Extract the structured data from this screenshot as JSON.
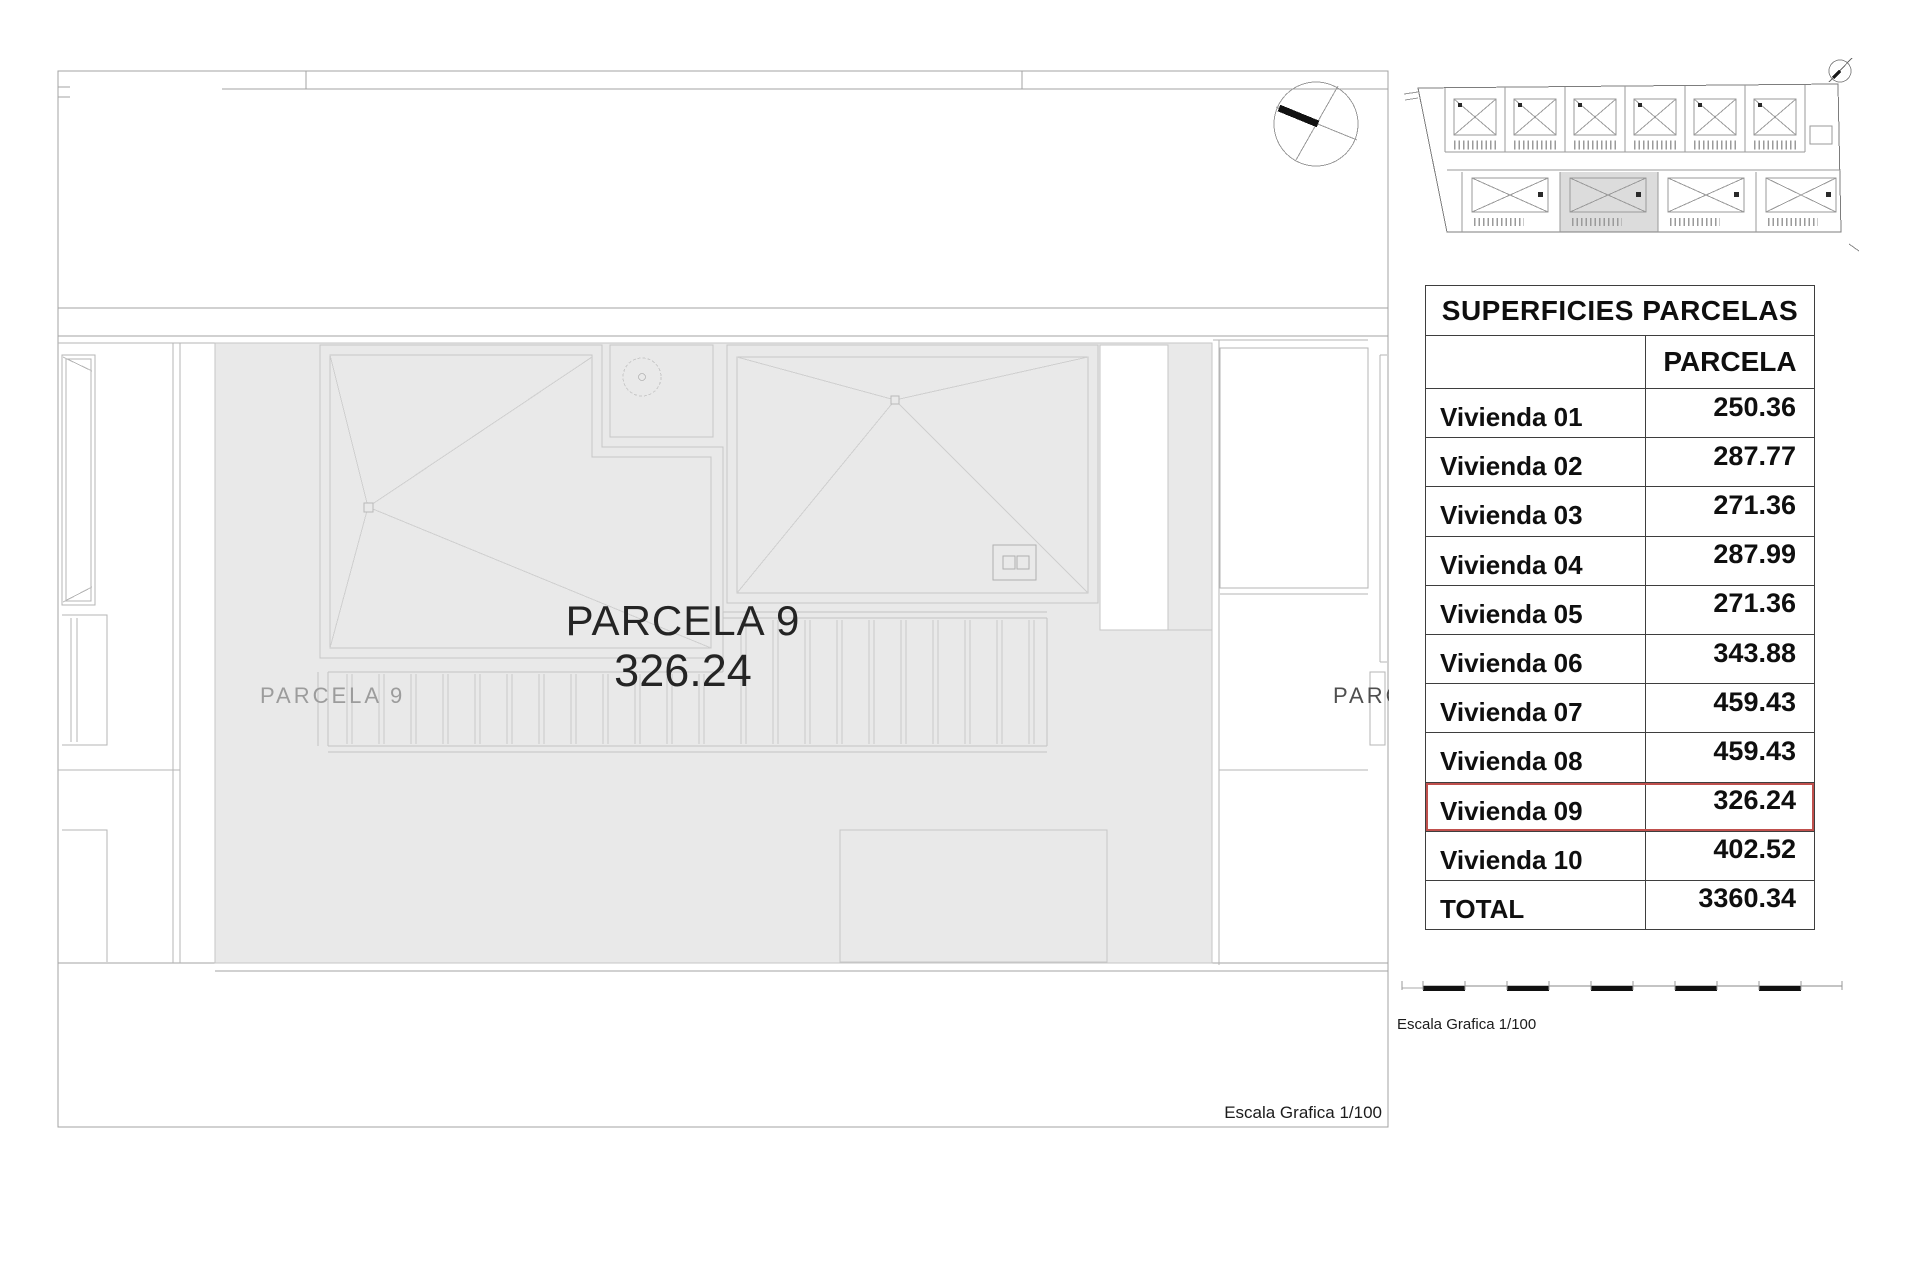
{
  "plan": {
    "parcel_title": "PARCELA 9",
    "parcel_area": "326.24",
    "left_parcel_label": "PARCELA 9",
    "right_parcel_label_clipped": "PARC",
    "scale_caption": "Escala Grafica 1/100"
  },
  "sidebar": {
    "table": {
      "title": "SUPERFICIES PARCELAS",
      "value_column_header": "PARCELA",
      "rows": [
        {
          "label": "Vivienda 01",
          "value": "250.36",
          "highlighted": false
        },
        {
          "label": "Vivienda 02",
          "value": "287.77",
          "highlighted": false
        },
        {
          "label": "Vivienda 03",
          "value": "271.36",
          "highlighted": false
        },
        {
          "label": "Vivienda 04",
          "value": "287.99",
          "highlighted": false
        },
        {
          "label": "Vivienda 05",
          "value": "271.36",
          "highlighted": false
        },
        {
          "label": "Vivienda 06",
          "value": "343.88",
          "highlighted": false
        },
        {
          "label": "Vivienda 07",
          "value": "459.43",
          "highlighted": false
        },
        {
          "label": "Vivienda 08",
          "value": "459.43",
          "highlighted": false
        },
        {
          "label": "Vivienda 09",
          "value": "326.24",
          "highlighted": true
        },
        {
          "label": "Vivienda 10",
          "value": "402.52",
          "highlighted": false
        },
        {
          "label": "TOTAL",
          "value": "3360.34",
          "highlighted": false
        }
      ],
      "highlight_color": "#c0504d"
    },
    "scale_caption": "Escala Grafica 1/100"
  },
  "colors": {
    "parcel_fill": "#e9e9e9",
    "mini_plan_highlight": "#dcdcdc",
    "highlight_border": "#c0504d"
  }
}
